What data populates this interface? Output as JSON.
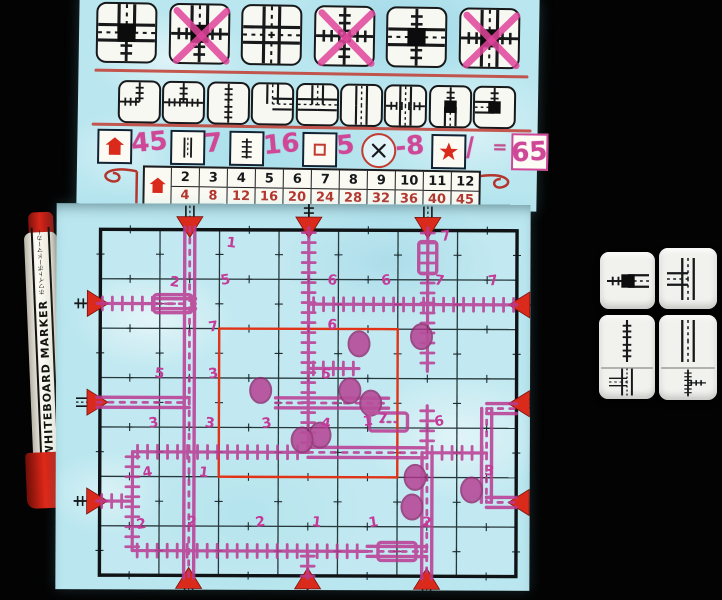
{
  "colors": {
    "sheet_blue": "#b9e6ef",
    "exit_red": "#d92a1c",
    "center_red": "#e03318",
    "marker_pink": "#ba3a92",
    "hand_pink": "#cf4897",
    "table_red": "#b5342c",
    "ink_black": "#17181a",
    "die_white": "#f1f1ee"
  },
  "flap": {
    "special_tiles": [
      {
        "icon": "special-station-road3-rail1",
        "arms": {
          "top": "road",
          "right": "road",
          "bottom": "rail",
          "left": "road"
        },
        "station": true,
        "crossed": false
      },
      {
        "icon": "special-station-rail3-road1",
        "arms": {
          "top": "road",
          "right": "rail",
          "bottom": "rail",
          "left": "rail"
        },
        "station": true,
        "crossed": true
      },
      {
        "icon": "road-crossroads",
        "arms": {
          "top": "road",
          "right": "road",
          "bottom": "road",
          "left": "road"
        },
        "station": false,
        "crossed": false
      },
      {
        "icon": "rail-crossroads",
        "arms": {
          "top": "rail",
          "right": "rail",
          "bottom": "rail",
          "left": "rail"
        },
        "station": false,
        "crossed": true
      },
      {
        "icon": "special-station-crossing",
        "arms": {
          "top": "rail",
          "right": "road",
          "bottom": "rail",
          "left": "road"
        },
        "station": true,
        "crossed": false
      },
      {
        "icon": "special-station-crossing-2",
        "arms": {
          "top": "road",
          "right": "rail",
          "bottom": "road",
          "left": "rail"
        },
        "station": true,
        "crossed": true
      }
    ],
    "basic_tiles": [
      {
        "icon": "rail-curve",
        "arms": {
          "left": "rail",
          "top": "rail"
        },
        "station": false
      },
      {
        "icon": "rail-t",
        "arms": {
          "left": "rail",
          "right": "rail",
          "top": "rail"
        },
        "station": false
      },
      {
        "icon": "rail-straight",
        "arms": {
          "top": "rail",
          "bottom": "rail"
        },
        "station": false
      },
      {
        "icon": "road-curve",
        "arms": {
          "top": "road",
          "right": "road"
        },
        "station": false
      },
      {
        "icon": "road-t",
        "arms": {
          "left": "road",
          "right": "road",
          "top": "road"
        },
        "station": false
      },
      {
        "icon": "road-straight",
        "arms": {
          "top": "road",
          "bottom": "road"
        },
        "station": false
      },
      {
        "icon": "overpass",
        "arms": {
          "top": "road",
          "bottom": "road",
          "left": "rail",
          "right": "rail"
        },
        "station": false,
        "overpass": true
      },
      {
        "icon": "station-straight",
        "arms": {
          "top": "rail",
          "bottom": "road"
        },
        "station": true
      },
      {
        "icon": "station-curve",
        "arms": {
          "left": "road",
          "top": "rail"
        },
        "station": true
      }
    ],
    "score_row": {
      "items": [
        {
          "icon": "house-icon",
          "value": "45"
        },
        {
          "icon": "road-icon",
          "value": "7"
        },
        {
          "icon": "rail-icon",
          "value": "16"
        },
        {
          "icon": "center-square-icon",
          "value": "5"
        },
        {
          "icon": "error-icon",
          "value": "-8"
        },
        {
          "icon": "star-icon",
          "value": "/"
        }
      ],
      "equals": "=",
      "total": "65"
    },
    "house_table": {
      "counts": [
        "2",
        "3",
        "4",
        "5",
        "6",
        "7",
        "8",
        "9",
        "10",
        "11",
        "12"
      ],
      "scores": [
        "4",
        "8",
        "12",
        "16",
        "20",
        "24",
        "28",
        "32",
        "36",
        "40",
        "45"
      ]
    }
  },
  "board": {
    "grid": {
      "cols": 7,
      "rows": 7
    },
    "exits": [
      {
        "side": "top",
        "pos": 2,
        "type": "road"
      },
      {
        "side": "top",
        "pos": 4,
        "type": "rail"
      },
      {
        "side": "top",
        "pos": 6,
        "type": "road"
      },
      {
        "side": "left",
        "pos": 2,
        "type": "rail"
      },
      {
        "side": "left",
        "pos": 4,
        "type": "road"
      },
      {
        "side": "left",
        "pos": 6,
        "type": "rail"
      },
      {
        "side": "right",
        "pos": 2,
        "type": "rail"
      },
      {
        "side": "right",
        "pos": 4,
        "type": "road"
      },
      {
        "side": "right",
        "pos": 6,
        "type": "rail"
      },
      {
        "side": "bottom",
        "pos": 2,
        "type": "road"
      },
      {
        "side": "bottom",
        "pos": 4,
        "type": "rail"
      },
      {
        "side": "bottom",
        "pos": 6,
        "type": "road"
      }
    ],
    "drawn": {
      "roads": [
        {
          "x1": 2,
          "y1": 0.45,
          "x2": 2,
          "y2": 7.55
        },
        {
          "x1": 0.45,
          "y1": 4,
          "x2": 2,
          "y2": 4
        },
        {
          "x1": 1.45,
          "y1": 2,
          "x2": 2.1,
          "y2": 2
        },
        {
          "x1": 3.45,
          "y1": 4,
          "x2": 5.35,
          "y2": 4
        },
        {
          "x1": 4,
          "y1": 5,
          "x2": 6,
          "y2": 5
        },
        {
          "x1": 6,
          "y1": 5,
          "x2": 6,
          "y2": 7.55
        },
        {
          "x1": 5,
          "y1": 7,
          "x2": 6,
          "y2": 7
        },
        {
          "x1": 7,
          "y1": 4.1,
          "x2": 7.5,
          "y2": 4.1
        },
        {
          "x1": 7,
          "y1": 4.1,
          "x2": 7,
          "y2": 6
        },
        {
          "x1": 7,
          "y1": 6,
          "x2": 7.5,
          "y2": 6
        }
      ],
      "rails": [
        {
          "x1": 4,
          "y1": 0.45,
          "x2": 4,
          "y2": 5
        },
        {
          "x1": 4,
          "y1": 2,
          "x2": 7.5,
          "y2": 2
        },
        {
          "x1": 0.45,
          "y1": 2,
          "x2": 1.45,
          "y2": 2
        },
        {
          "x1": 6,
          "y1": 0.45,
          "x2": 6,
          "y2": 3.35
        },
        {
          "x1": 4,
          "y1": 3.3,
          "x2": 4.85,
          "y2": 3.3
        },
        {
          "x1": 6,
          "y1": 4.05,
          "x2": 6,
          "y2": 5
        },
        {
          "x1": 1.05,
          "y1": 5,
          "x2": 4,
          "y2": 5
        },
        {
          "x1": 6,
          "y1": 5,
          "x2": 7,
          "y2": 5
        },
        {
          "x1": 1.05,
          "y1": 5,
          "x2": 1.05,
          "y2": 7
        },
        {
          "x1": 0.45,
          "y1": 6,
          "x2": 1.05,
          "y2": 6
        },
        {
          "x1": 1.05,
          "y1": 7,
          "x2": 5,
          "y2": 7
        },
        {
          "x1": 4,
          "y1": 7,
          "x2": 4,
          "y2": 7.55
        }
      ],
      "stations": [
        [
          4.85,
          2.8
        ],
        [
          5.9,
          2.65
        ],
        [
          3.2,
          3.75
        ],
        [
          4.7,
          3.75
        ],
        [
          5.05,
          4.0
        ],
        [
          4.2,
          4.65
        ],
        [
          3.9,
          4.75
        ],
        [
          5.8,
          5.5
        ],
        [
          5.75,
          6.1
        ],
        [
          6.75,
          5.75
        ]
      ],
      "station_boxes": [
        {
          "c": 1.72,
          "r": 2,
          "o": "h"
        },
        {
          "c": 6,
          "r": 1.05,
          "o": "v"
        },
        {
          "c": 5.35,
          "r": 4.38,
          "o": "h"
        },
        {
          "c": 5.5,
          "r": 7,
          "o": "h"
        }
      ],
      "numbers": [
        {
          "n": "1",
          "c": 2.7,
          "r": 0.75
        },
        {
          "n": "7",
          "c": 6.3,
          "r": 0.6
        },
        {
          "n": "2",
          "c": 1.75,
          "r": 1.55
        },
        {
          "n": "5",
          "c": 2.6,
          "r": 1.5
        },
        {
          "n": "6",
          "c": 4.4,
          "r": 1.5
        },
        {
          "n": "6",
          "c": 5.3,
          "r": 1.5
        },
        {
          "n": "7",
          "c": 6.2,
          "r": 1.5
        },
        {
          "n": "7",
          "c": 7.1,
          "r": 1.5
        },
        {
          "n": "6",
          "c": 4.4,
          "r": 2.4
        },
        {
          "n": "7",
          "c": 2.4,
          "r": 2.45
        },
        {
          "n": "5",
          "c": 1.5,
          "r": 3.4
        },
        {
          "n": "3",
          "c": 2.4,
          "r": 3.4
        },
        {
          "n": "5",
          "c": 4.3,
          "r": 3.4
        },
        {
          "n": "3",
          "c": 1.4,
          "r": 4.4
        },
        {
          "n": "3",
          "c": 2.35,
          "r": 4.4
        },
        {
          "n": "3",
          "c": 3.3,
          "r": 4.4
        },
        {
          "n": "4",
          "c": 4.3,
          "r": 4.4
        },
        {
          "n": "1",
          "c": 5.0,
          "r": 4.35
        },
        {
          "n": "7",
          "c": 5.25,
          "r": 4.3
        },
        {
          "n": "6",
          "c": 6.2,
          "r": 4.35
        },
        {
          "n": "3",
          "c": 7.05,
          "r": 5.35
        },
        {
          "n": "4",
          "c": 1.3,
          "r": 5.4
        },
        {
          "n": "1",
          "c": 2.25,
          "r": 5.4
        },
        {
          "n": "2",
          "c": 1.2,
          "r": 6.45
        },
        {
          "n": "2",
          "c": 2.05,
          "r": 6.4
        },
        {
          "n": "2",
          "c": 3.2,
          "r": 6.4
        },
        {
          "n": "1",
          "c": 4.15,
          "r": 6.4
        },
        {
          "n": "1",
          "c": 5.1,
          "r": 6.4
        },
        {
          "n": "2",
          "c": 6.0,
          "r": 6.4
        }
      ]
    }
  },
  "dice": [
    {
      "faces": [
        "station-straight-h"
      ]
    },
    {
      "faces": [
        "road-t-left"
      ]
    },
    {
      "faces": [
        "rail-straight",
        "road-t-front"
      ]
    },
    {
      "faces": [
        "road-straight",
        "rail-t-right"
      ]
    }
  ],
  "marker": {
    "label": "WHITEBOARD MARKER",
    "label_jp": "ホワイトボードマーカー"
  }
}
